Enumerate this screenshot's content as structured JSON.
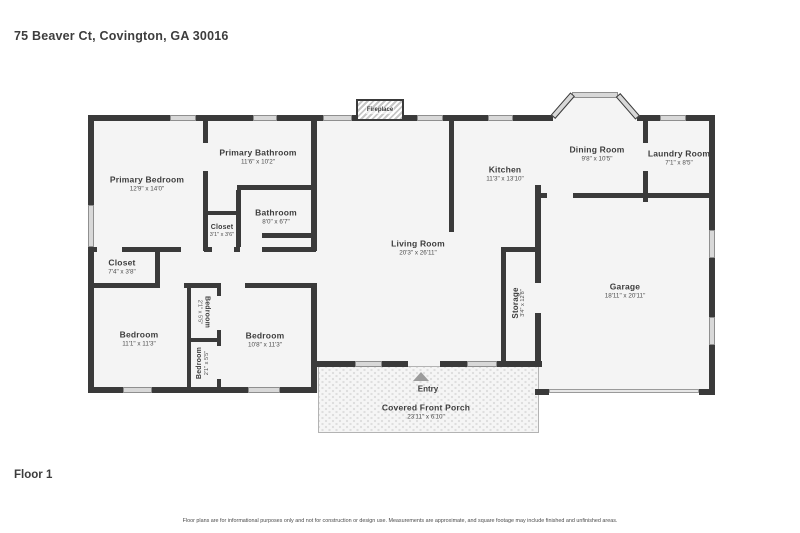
{
  "header": {
    "address": "75 Beaver Ct, Covington, GA 30016"
  },
  "footer": {
    "floor_label": "Floor 1",
    "disclaimer": "Floor plans are for informational purposes only and not for construction or design use. Measurements are approximate, and square footage may include finished and unfinished areas."
  },
  "plan": {
    "fireplace_label": "Fireplace",
    "entry_label": "Entry",
    "colors": {
      "wall": "#3a3a3a",
      "floor": "#f4f4f4",
      "window": "#d8d8d8"
    },
    "rooms": {
      "primary_bedroom": {
        "name": "Primary Bedroom",
        "dims": "12'9\" x 14'0\""
      },
      "primary_bathroom": {
        "name": "Primary Bathroom",
        "dims": "11'6\" x 10'2\""
      },
      "bathroom": {
        "name": "Bathroom",
        "dims": "8'0\" x 6'7\""
      },
      "closet_small": {
        "name": "Closet",
        "dims": "3'1\" x 3'6\""
      },
      "closet_hall": {
        "name": "Closet",
        "dims": "7'4\" x 3'8\""
      },
      "bedroom_left": {
        "name": "Bedroom",
        "dims": "11'1\" x 11'3\""
      },
      "bedroom_closet_top": {
        "name": "Bedroom",
        "dims": "2'1\" x 5'5\""
      },
      "bedroom_closet_bottom": {
        "name": "Bedroom",
        "dims": "2'1\" x 5'5\""
      },
      "bedroom_right": {
        "name": "Bedroom",
        "dims": "10'8\" x 11'3\""
      },
      "living_room": {
        "name": "Living Room",
        "dims": "20'3\" x 26'11\""
      },
      "kitchen": {
        "name": "Kitchen",
        "dims": "11'3\" x 13'10\""
      },
      "dining_room": {
        "name": "Dining Room",
        "dims": "9'8\" x 10'5\""
      },
      "laundry_room": {
        "name": "Laundry Room",
        "dims": "7'1\" x 8'5\""
      },
      "storage": {
        "name": "Storage",
        "dims": "3'4\" x 12'8\""
      },
      "garage": {
        "name": "Garage",
        "dims": "18'11\" x 20'11\""
      },
      "porch": {
        "name": "Covered Front Porch",
        "dims": "23'11\" x 6'10\""
      }
    }
  }
}
